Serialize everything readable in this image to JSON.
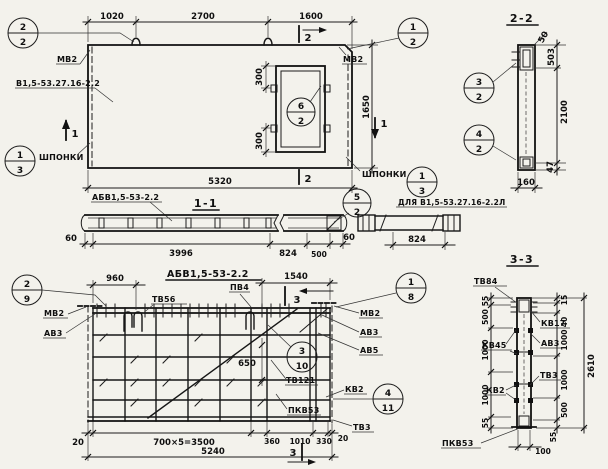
{
  "meta": {
    "bg": "#f3f2ec",
    "ink": "#111111",
    "sheet_type": "panel working drawing"
  },
  "plan": {
    "dim_1020": "1020",
    "dim_2700": "2700",
    "dim_1600": "1600",
    "dim_5320": "5320",
    "dim_1650": "1650",
    "dim_300_top": "300",
    "dim_300_bot": "300",
    "cut1": "1",
    "cut2": "2",
    "callout_top_left": {
      "num": "2",
      "den": "2"
    },
    "callout_top_right": {
      "num": "1",
      "den": "2"
    },
    "callout_opening": {
      "num": "6",
      "den": "2"
    },
    "callout_key_left": {
      "num": "1",
      "den": "3"
    },
    "callout_key_right": {
      "num": "1",
      "den": "3"
    },
    "label_mv2_left": "МВ2",
    "label_mv2_right": "МВ2",
    "label_mark": "В1,5-53.27.16-2.2",
    "label_key_left": "ШПОНКИ",
    "label_key_right": "ШПОНКИ"
  },
  "section11": {
    "title": "1-1",
    "label": "АБВ1,5-53-2.2",
    "dim_60_left": "60",
    "dim_3996": "3996",
    "dim_824": "824",
    "dim_500": "500",
    "dim_60_right": "60",
    "callout": {
      "num": "5",
      "den": "2"
    }
  },
  "detail824": {
    "label": "ДЛЯ В1,5-53.27.16-2.2Л",
    "dim_824": "824"
  },
  "section22": {
    "title": "2-2",
    "dim_50": "50",
    "dim_503": "503",
    "dim_2100": "2100",
    "dim_47": "47",
    "dim_160": "160",
    "callout_top": {
      "num": "3",
      "den": "2"
    },
    "callout_bottom": {
      "num": "4",
      "den": "2"
    }
  },
  "rebar": {
    "title": "АБВ1,5-53-2.2",
    "dim_960": "960",
    "dim_1540": "1540",
    "dim_650": "650",
    "dim_20_left": "20",
    "dim_3500": "700×5=3500",
    "dim_360": "360",
    "dim_1010": "1010",
    "dim_330": "330",
    "dim_20_right": "20",
    "dim_5240": "5240",
    "cut3": "3",
    "callout_top_left": {
      "num": "2",
      "den": "9"
    },
    "callout_top_right": {
      "num": "1",
      "den": "8"
    },
    "callout_middle": {
      "num": "3",
      "den": "10"
    },
    "callout_bottom_right": {
      "num": "4",
      "den": "11"
    },
    "labels": {
      "mv2_left": "МВ2",
      "av3_left": "АВ3",
      "tv56": "ТВ56",
      "pv4": "ПВ4",
      "mv2_right": "МВ2",
      "av3_right": "АВ3",
      "av5": "АВ5",
      "tv121": "ТВ121",
      "kv2": "КВ2",
      "pkv53": "ПКВ53",
      "tv3": "ТВ3"
    }
  },
  "section33": {
    "title": "3-3",
    "labels": {
      "tv84": "ТВ84",
      "kv17": "КВ17",
      "av3": "АВ3",
      "kv45": "КВ45",
      "kv2": "КВ2",
      "tv3": "ТВ3",
      "pkv53": "ПКВ53"
    },
    "dims_left": [
      "55",
      "500",
      "1000",
      "1000",
      "55"
    ],
    "dims_right": [
      "15",
      "40",
      "1000",
      "1000",
      "500",
      "55"
    ],
    "dim_total": "2610",
    "dim_100": "100"
  }
}
